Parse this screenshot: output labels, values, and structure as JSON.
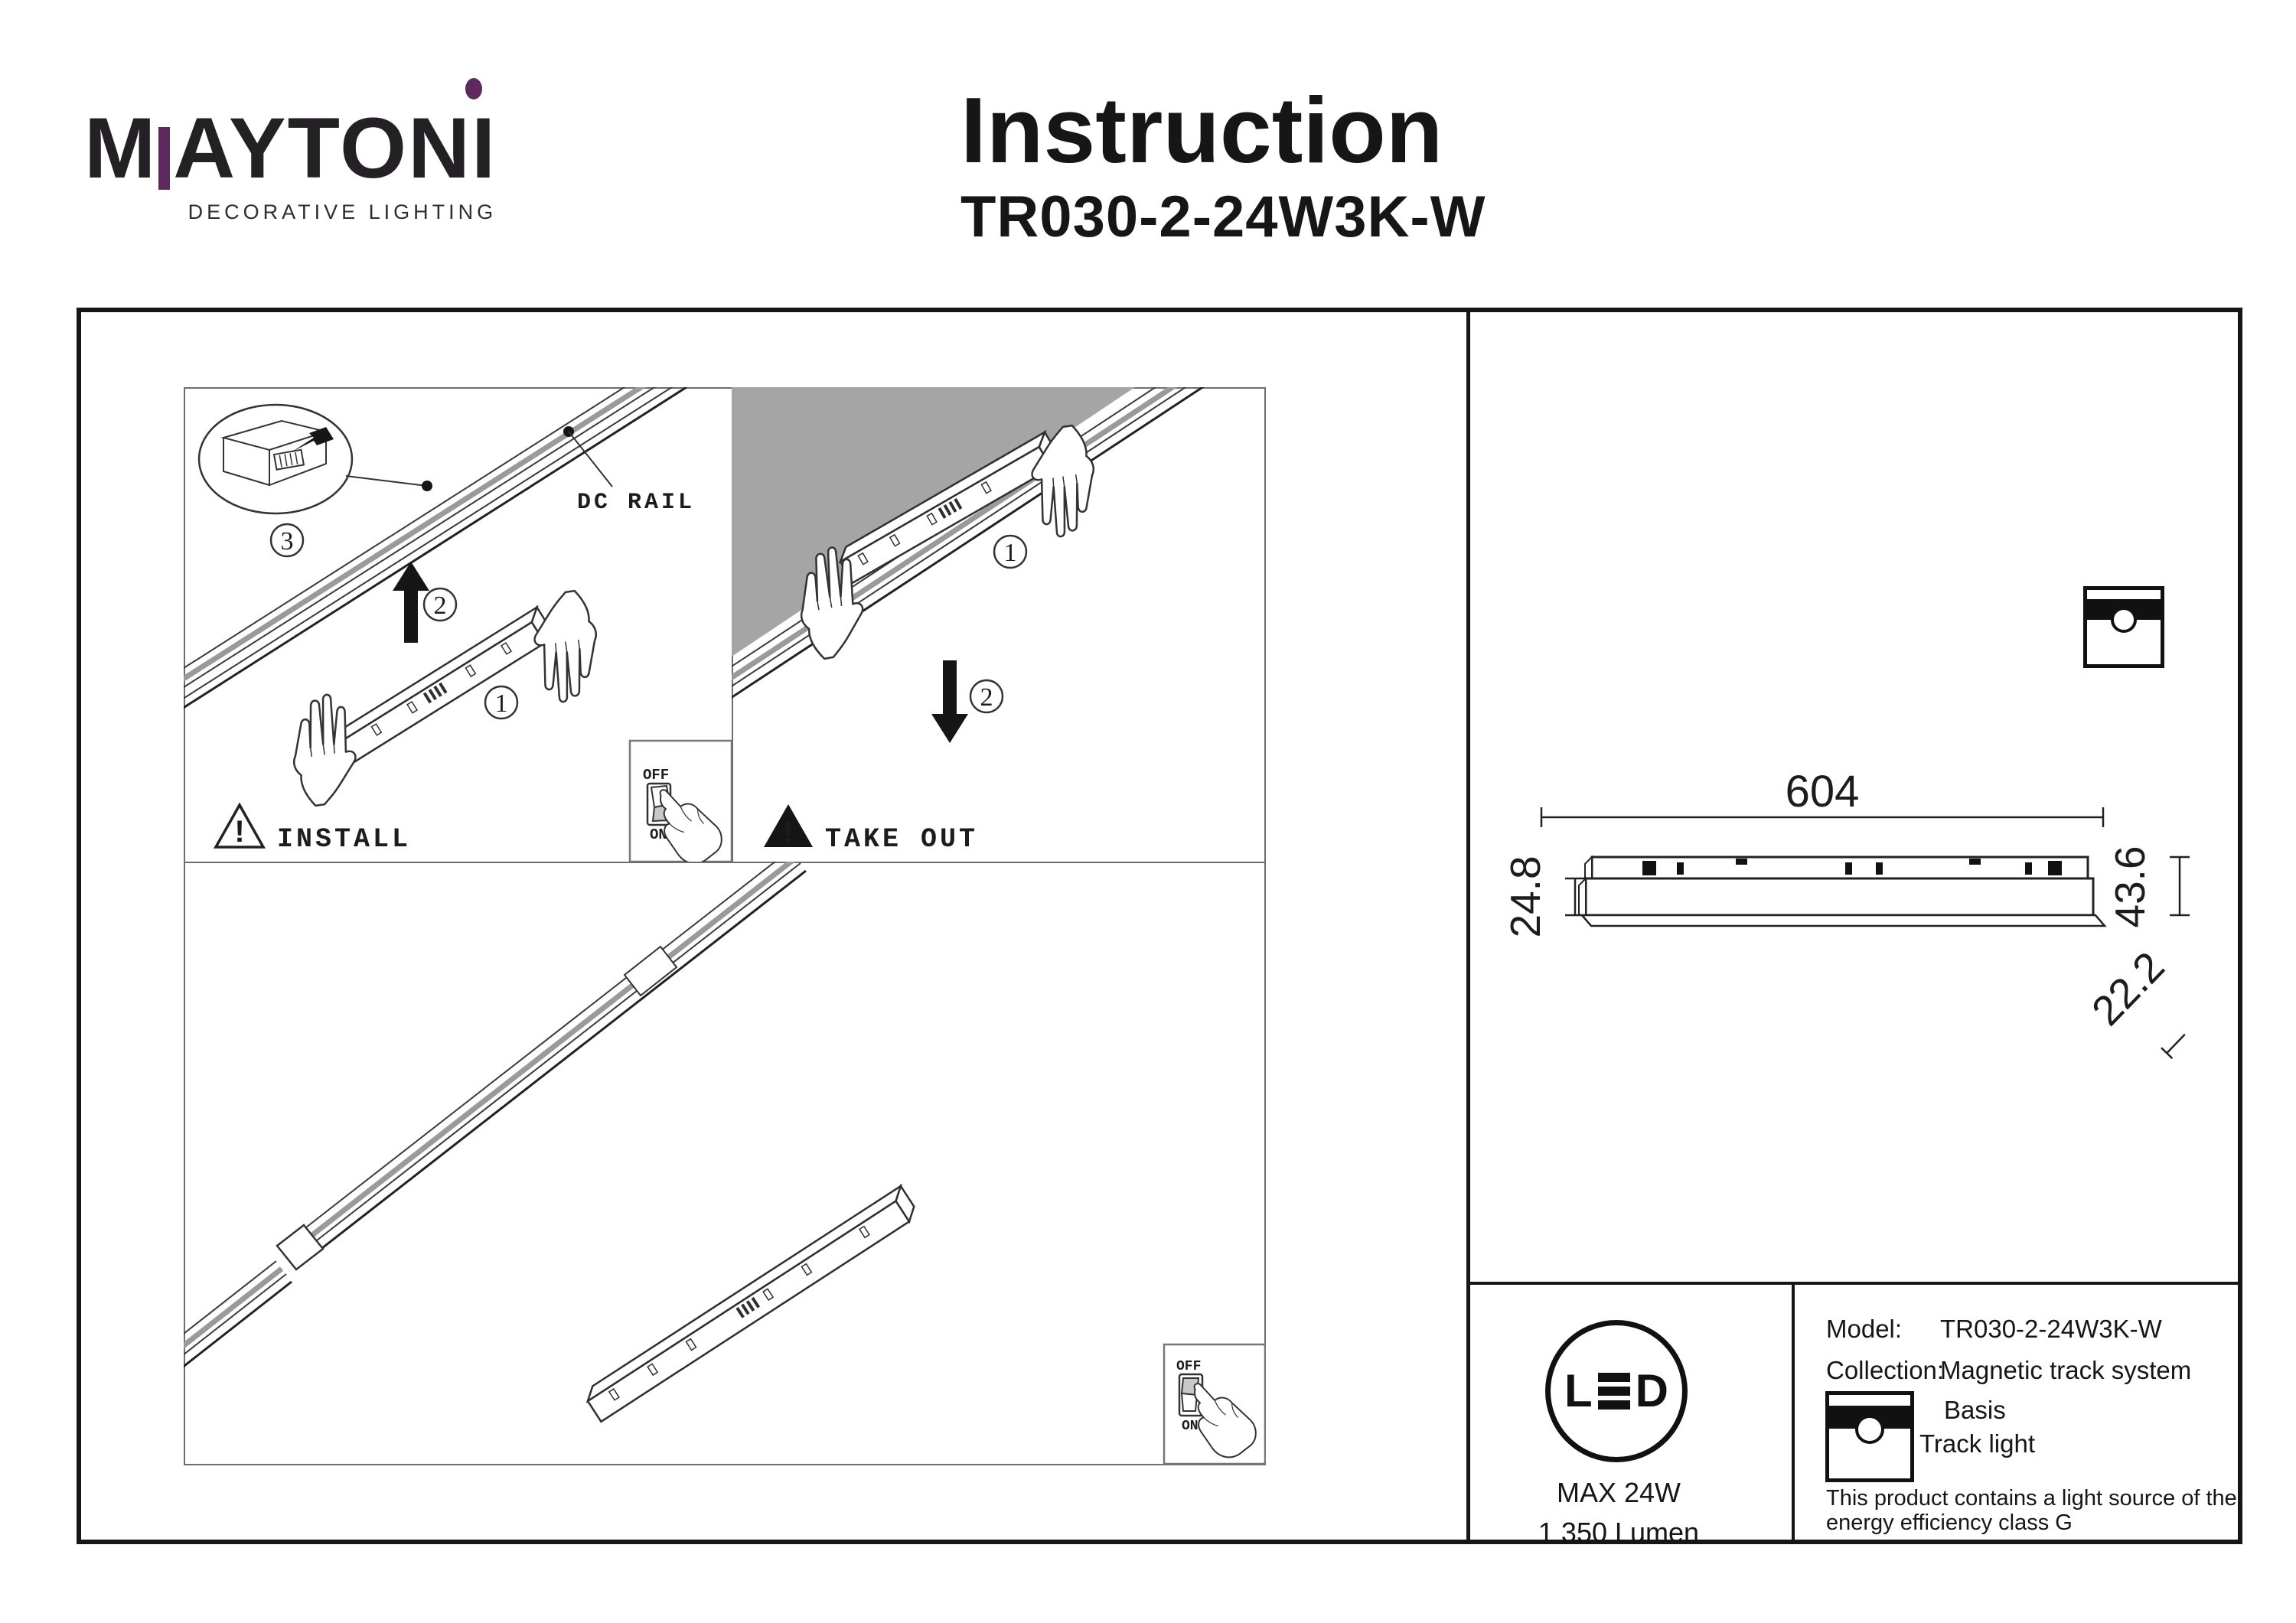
{
  "brand": {
    "wordmark_m": "M",
    "wordmark_rest": "AYTON",
    "wordmark_i": "I",
    "tagline": "DECORATIVE LIGHTING",
    "accent_color": "#5e2a5e"
  },
  "header": {
    "title": "Instruction",
    "model": "TR030-2-24W3K-W"
  },
  "install": {
    "caption": "INSTALL",
    "warning_mark": "!",
    "rail_label": "DC RAIL",
    "step1": "1",
    "step2": "2",
    "step3": "3",
    "switch_off": "OFF",
    "switch_on": "ON"
  },
  "takeout": {
    "caption": "TAKE OUT",
    "warning_mark": "!",
    "step1": "1",
    "step2": "2"
  },
  "overview": {
    "switch_off": "OFF",
    "switch_on": "ON"
  },
  "dims": {
    "length": "604",
    "base_height": "24.8",
    "total_height": "43.6",
    "width": "22.2"
  },
  "led": {
    "name": "LED",
    "l": "L",
    "d": "D",
    "max_power": "MAX 24W",
    "luminous_flux": "1 350 Lumen"
  },
  "info": {
    "model_label": "Model:",
    "model_value": "TR030-2-24W3K-W",
    "collection_label": "Collection:",
    "collection_value": "Magnetic track system",
    "type_line1": "Basis",
    "type_line2": "Track light",
    "efficiency_line1": "This product contains a light source of the",
    "efficiency_line2": "energy efficiency class G"
  }
}
